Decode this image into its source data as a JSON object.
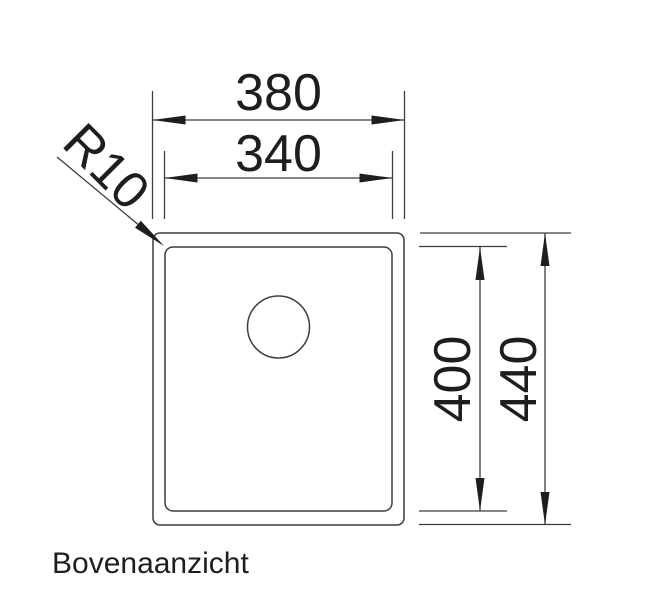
{
  "drawing": {
    "view_label": "Bovenaanzicht",
    "dimensions": {
      "outer_width": "380",
      "inner_width": "340",
      "inner_height": "400",
      "outer_height": "440",
      "corner_radius": "R10"
    },
    "colors": {
      "line": "#3d3d3d",
      "text": "#1e1e1e",
      "background": "#ffffff"
    }
  }
}
